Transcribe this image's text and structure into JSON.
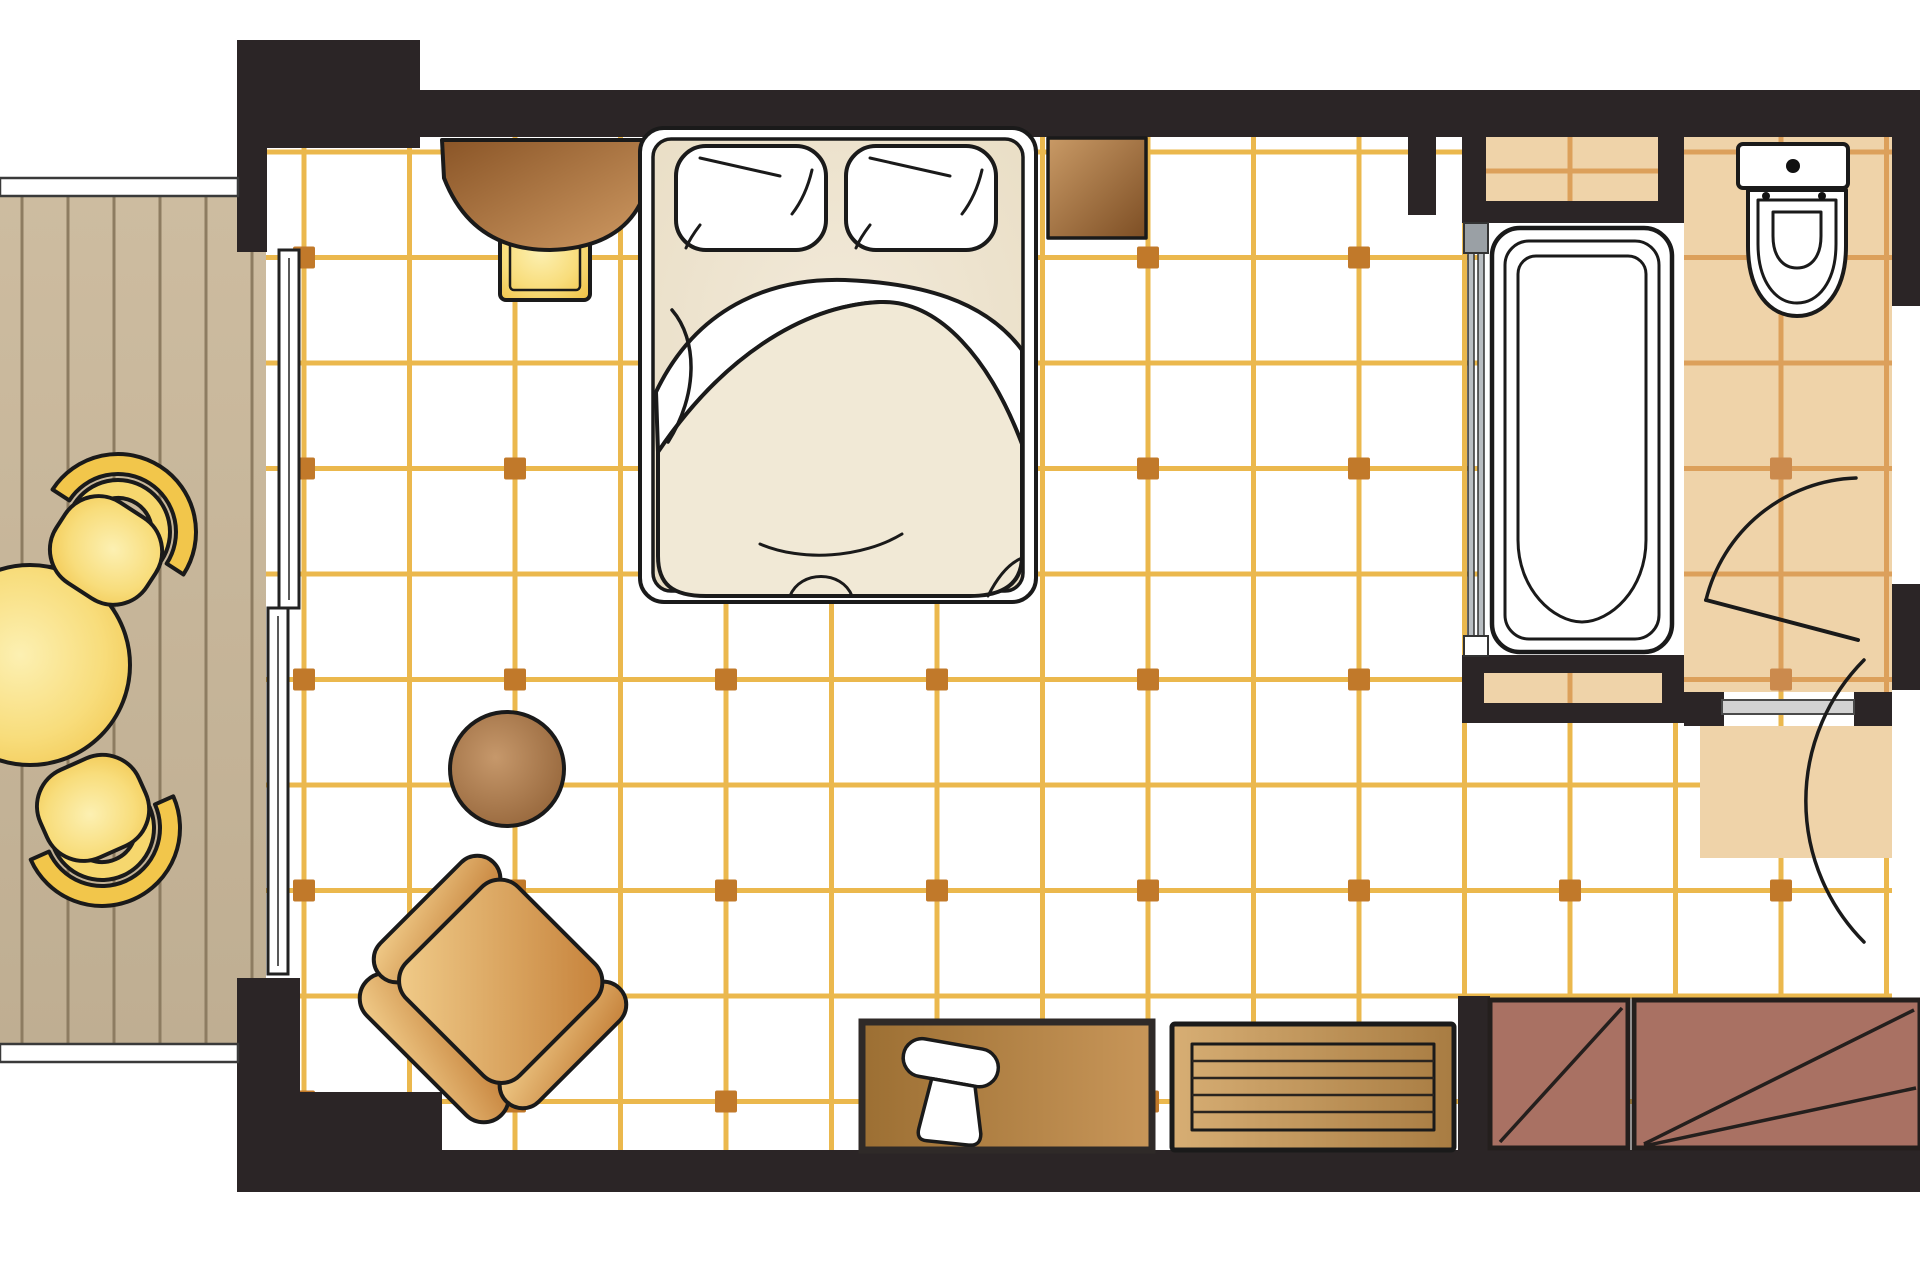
{
  "meta": {
    "kind": "hotel-room-floor-plan",
    "canvas": {
      "w": 1920,
      "h": 1280
    }
  },
  "colors": {
    "wall": "#2B2526",
    "outline": "#1A1A1A",
    "deck_bg": "#C7B69A",
    "deck_line": "#8D7C61",
    "floor_bg": "#FFFFFF",
    "grid_line": "#EBB84D",
    "grid_marker": "#C1792A",
    "bath_bg": "#EFD3A9",
    "bath_line": "#DCA05B",
    "bath_marker": "#CB8A4D",
    "glass": "#B9BEC2",
    "glass_cap": "#9AA0A5",
    "sill": "#D2D2D2",
    "wardrobe": "#A97163",
    "bed_body": "#EDE4CF",
    "duvet": "#F1E9D6",
    "yellow_main": "#F2C64B",
    "yellow_mid": "#F6D76E",
    "yellow_glow": "#FBEFAF",
    "white": "#FFFFFF"
  },
  "floors": {
    "main": {
      "x": 266,
      "y": 137,
      "w": 1626,
      "h": 1013,
      "originX": 304,
      "originY": 152,
      "cell": 105.5,
      "markerOriginY": 257.5,
      "lineWidth": 5,
      "markerSize": 22
    },
    "bath": {
      "x": 1684,
      "y": 137,
      "w": 208,
      "h": 555,
      "originX": 304,
      "originY": 152,
      "cell": 105.5,
      "markerOriginY": 257.5,
      "lineWidth": 5,
      "markerSize": 22
    }
  },
  "deck": {
    "x": 0,
    "y": 196,
    "w": 266,
    "h": 848,
    "plankStart": 22,
    "plankStep": 46,
    "lineWidth": 3
  },
  "furniture": {
    "balcony_table": "round-balcony-table",
    "balcony_chair_top": "balcony-chair-top",
    "balcony_chair_bottom": "balcony-chair-bottom",
    "desk": "dressing-desk",
    "stool": "stool",
    "bed": "double-bed",
    "pillow_left": "pillow-left",
    "pillow_right": "pillow-right",
    "nightstand": "nightstand",
    "side_table": "round-side-table",
    "armchair": "armchair",
    "tv_console": "tv-console",
    "tv": "television",
    "bench": "luggage-bench",
    "wardrobe": "wardrobe",
    "bathtub": "bathtub",
    "toilet": "toilet",
    "glass_partition": "glass-partition",
    "bathroom_door": "bathroom-door",
    "entrance_door": "entrance-door",
    "sliding_door": "balcony-sliding-door"
  }
}
